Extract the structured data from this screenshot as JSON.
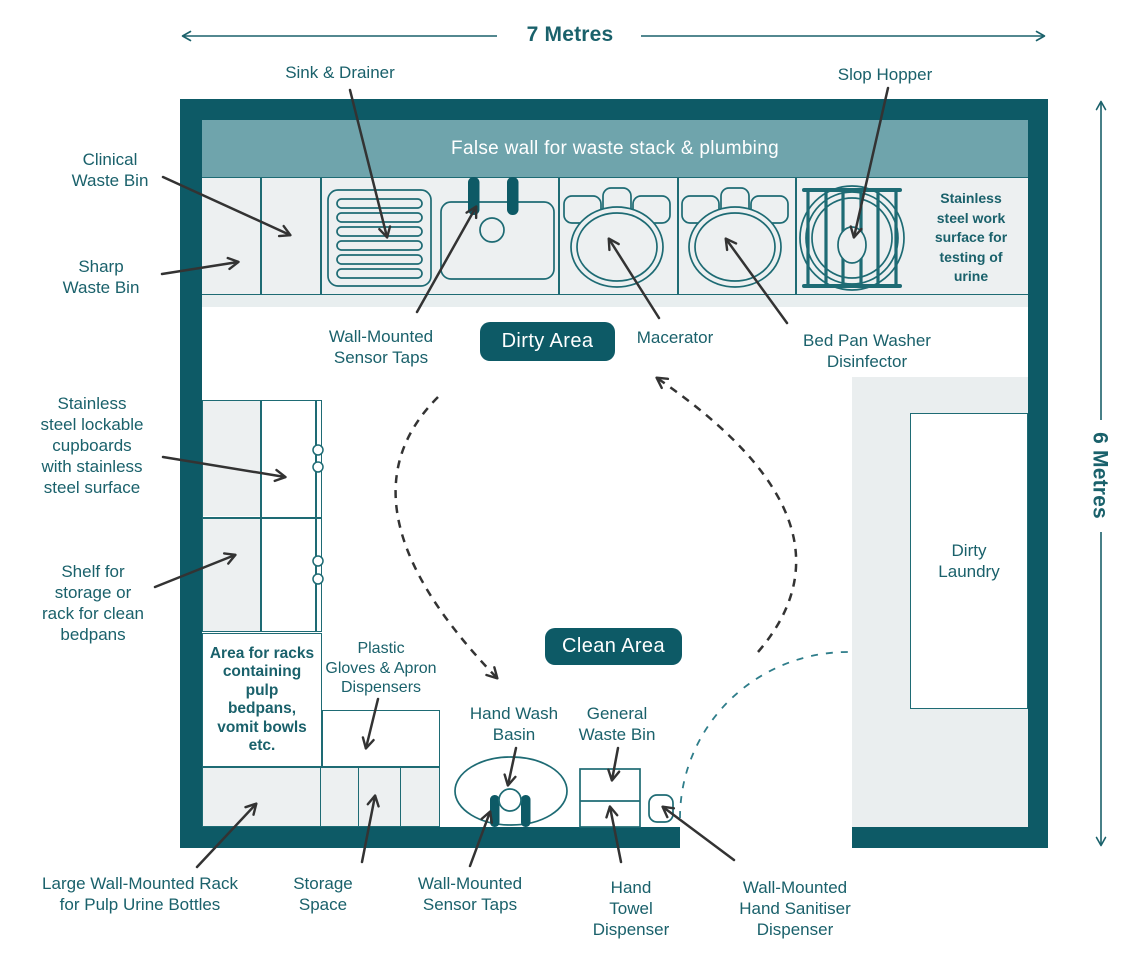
{
  "dimensions": {
    "width_label": "7 Metres",
    "height_label": "6 Metres"
  },
  "zones": {
    "false_wall": "False wall for waste stack & plumbing",
    "dirty_area_badge": "Dirty Area",
    "clean_area_badge": "Clean Area",
    "dirty_laundry": "Dirty\nLaundry",
    "area_for_racks": "Area for racks\ncontaining\npulp\nbedpans,\nvomit bowls\netc.",
    "work_surface": "Stainless\nsteel work\nsurface for\ntesting of\nurine"
  },
  "labels": {
    "sink_drainer": "Sink & Drainer",
    "slop_hopper": "Slop Hopper",
    "clinical_waste_bin": "Clinical\nWaste Bin",
    "sharp_waste_bin": "Sharp\nWaste Bin",
    "sensor_taps_top": "Wall-Mounted\nSensor Taps",
    "macerator": "Macerator",
    "bedpan_washer": "Bed Pan Washer\nDisinfector",
    "cupboards": "Stainless\nsteel lockable\ncupboards\nwith stainless\nsteel surface",
    "shelf": "Shelf for\nstorage or\nrack for clean\nbedpans",
    "gloves": "Plastic\nGloves & Apron\nDispensers",
    "hand_wash_basin": "Hand Wash\nBasin",
    "general_waste_bin": "General\nWaste Bin",
    "large_rack": "Large Wall-Mounted Rack\nfor Pulp Urine Bottles",
    "storage_space": "Storage\nSpace",
    "sensor_taps_bottom": "Wall-Mounted\nSensor Taps",
    "hand_towel": "Hand\nTowel\nDispenser",
    "hand_sanitiser": "Wall-Mounted\nHand Sanitiser\nDispenser"
  },
  "colors": {
    "wall": "#0d5a66",
    "false_wall": "#6fa4ac",
    "outline": "#1e6b74",
    "cell_fill": "#edf0f1",
    "laundry_fill": "#eaeeef",
    "text": "#1a616b",
    "badge": "#0d5a66",
    "arrow": "#333333",
    "door_arc": "#2e7d8a"
  }
}
